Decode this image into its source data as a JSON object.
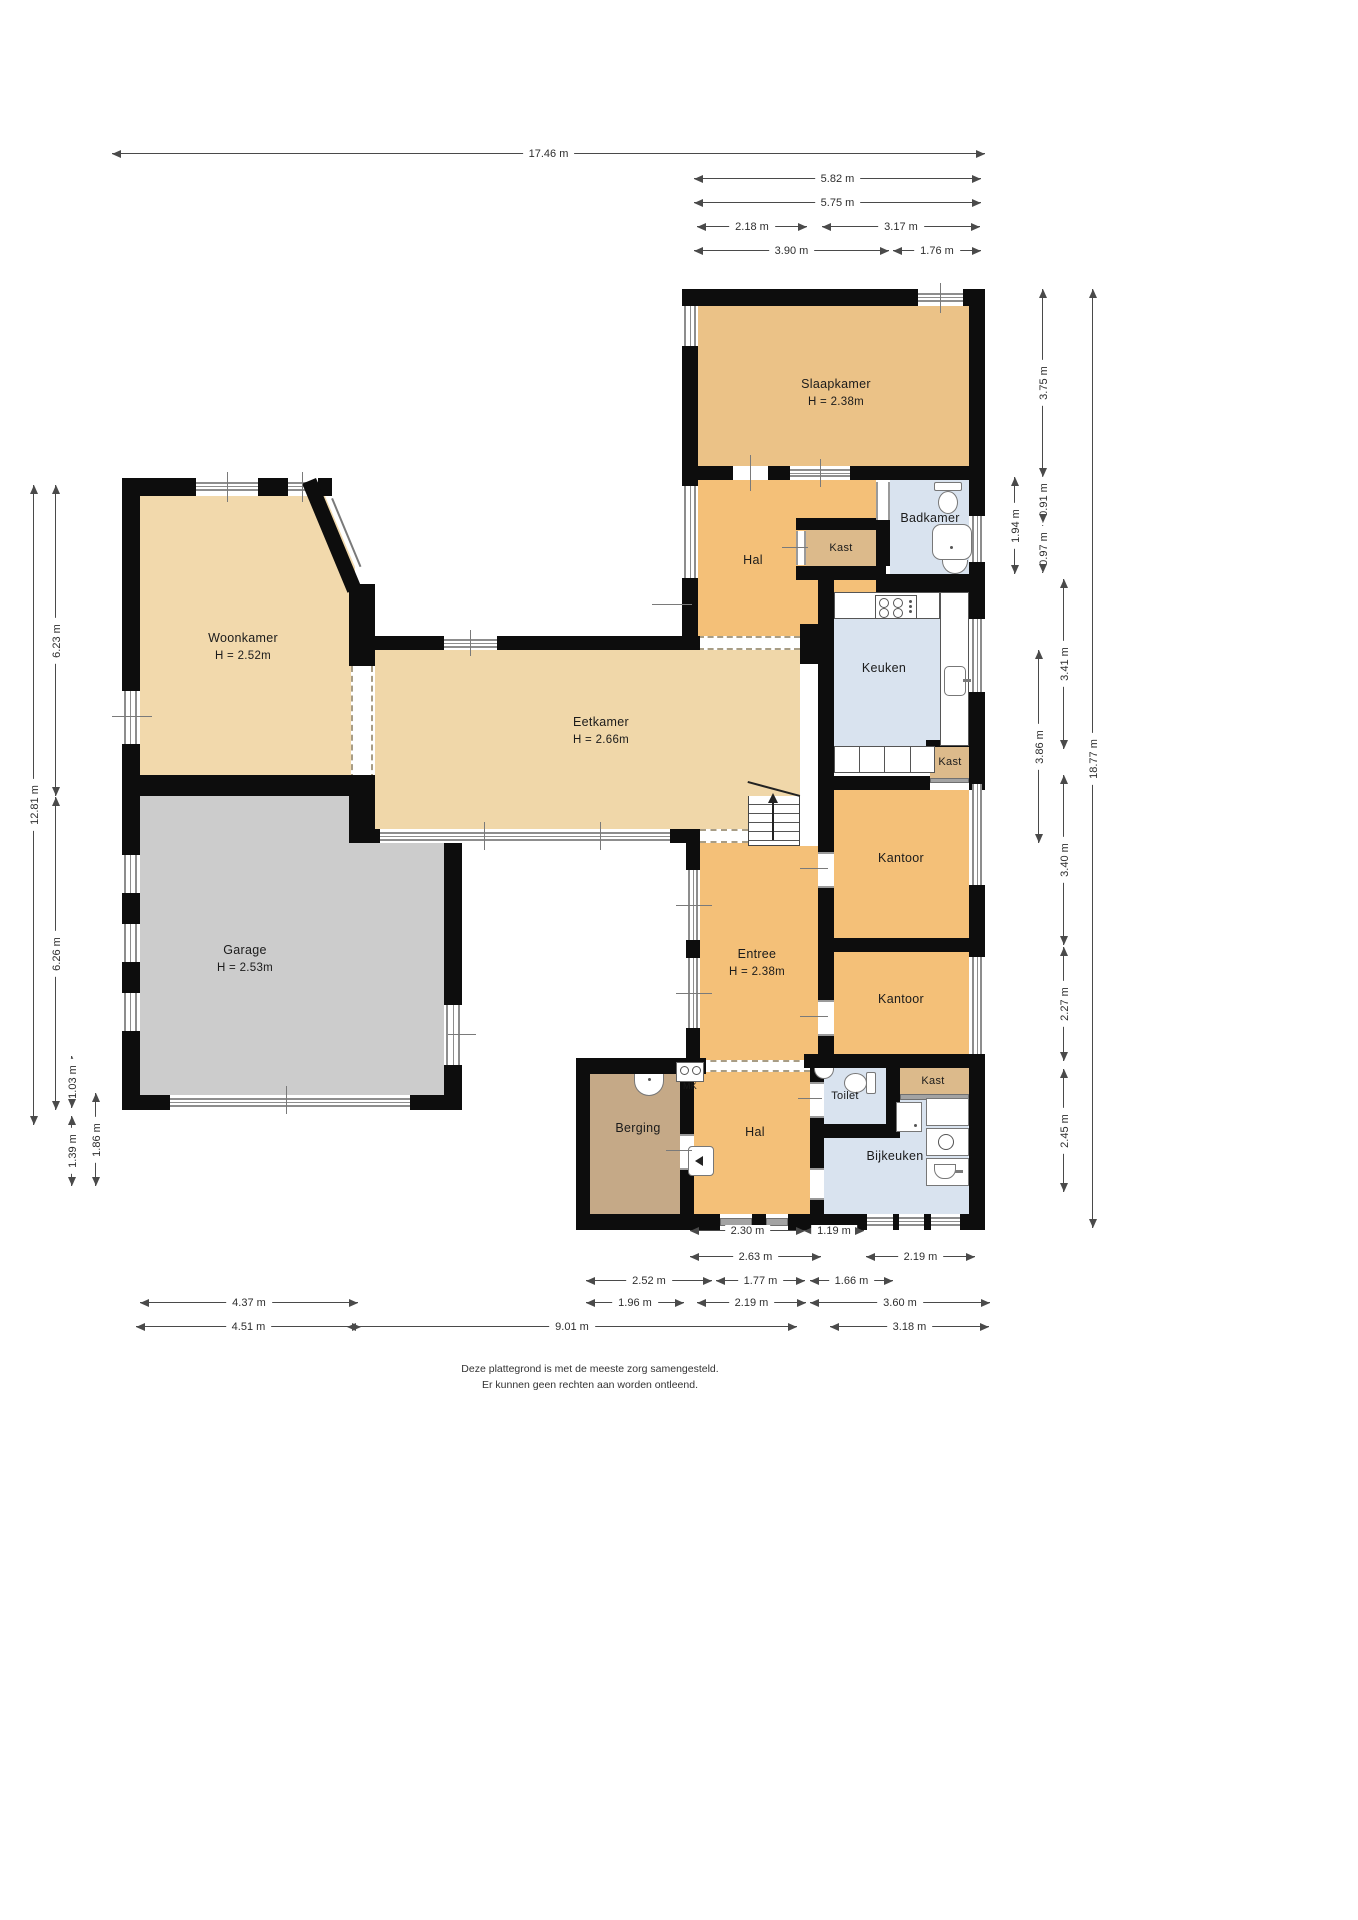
{
  "title": "Plattegrond begane grond",
  "colors": {
    "wall": "#0d0d0d",
    "room_tan_light": "#f0d7a9",
    "room_tan": "#f2d9ac",
    "room_bedroom": "#ebc287",
    "room_orange": "#f4c078",
    "room_closet": "#dcba8b",
    "room_storage": "#c5a987",
    "room_wet_blue": "#d9e3ef",
    "room_garage": "#cccccc",
    "window_gray": "#8d8d8d",
    "dimension_line": "#4a4a4a"
  },
  "rooms": {
    "slaapkamer": {
      "name": "Slaapkamer",
      "height": "H = 2.38m"
    },
    "hal_boven": {
      "name": "Hal"
    },
    "kast_boven": {
      "name": "Kast"
    },
    "badkamer": {
      "name": "Badkamer"
    },
    "keuken": {
      "name": "Keuken"
    },
    "kast_midden": {
      "name": "Kast"
    },
    "kantoor_boven": {
      "name": "Kantoor"
    },
    "kantoor_onder": {
      "name": "Kantoor"
    },
    "eetkamer": {
      "name": "Eetkamer",
      "height": "H = 2.66m"
    },
    "woonkamer": {
      "name": "Woonkamer",
      "height": "H = 2.52m"
    },
    "garage": {
      "name": "Garage",
      "height": "H = 2.53m"
    },
    "entree": {
      "name": "Entree",
      "height": "H = 2.38m"
    },
    "berging": {
      "name": "Berging"
    },
    "meterkast": {
      "name": "MK"
    },
    "hal_beneden": {
      "name": "Hal"
    },
    "toilet": {
      "name": "Toilet"
    },
    "kast_onder": {
      "name": "Kast"
    },
    "bijkeuken": {
      "name": "Bijkeuken"
    }
  },
  "dimensions": {
    "top": [
      {
        "label": "17.46 m"
      },
      {
        "label": "5.82 m"
      },
      {
        "label": "5.75 m"
      },
      {
        "label": "2.18 m"
      },
      {
        "label": "3.17 m"
      },
      {
        "label": "3.90 m"
      },
      {
        "label": "1.76 m"
      }
    ],
    "bottom": [
      {
        "label": "2.30 m"
      },
      {
        "label": "1.19 m"
      },
      {
        "label": "2.63 m"
      },
      {
        "label": "2.19 m"
      },
      {
        "label": "2.52 m"
      },
      {
        "label": "1.77 m"
      },
      {
        "label": "1.66 m"
      },
      {
        "label": "4.37 m"
      },
      {
        "label": "1.96 m"
      },
      {
        "label": "2.19 m"
      },
      {
        "label": "3.60 m"
      },
      {
        "label": "4.51 m"
      },
      {
        "label": "9.01 m"
      },
      {
        "label": "3.18 m"
      }
    ],
    "left": [
      {
        "label": "12.81 m"
      },
      {
        "label": "6.23 m"
      },
      {
        "label": "6.26 m"
      },
      {
        "label": "1.03 m"
      },
      {
        "label": "1.39 m"
      },
      {
        "label": "1.86 m"
      }
    ],
    "right": [
      {
        "label": "3.75 m"
      },
      {
        "label": "1.94 m"
      },
      {
        "label": "0.91 m"
      },
      {
        "label": "0.97 m"
      },
      {
        "label": "3.41 m"
      },
      {
        "label": "3.86 m"
      },
      {
        "label": "3.40 m"
      },
      {
        "label": "2.27 m"
      },
      {
        "label": "2.45 m"
      },
      {
        "label": "18.77 m"
      }
    ]
  },
  "icons": [
    {
      "name": "toilet-icon"
    },
    {
      "name": "shower-icon"
    },
    {
      "name": "washbasin-icon"
    },
    {
      "name": "hob-icon"
    },
    {
      "name": "kitchen-sink-icon"
    },
    {
      "name": "stairs-icon"
    },
    {
      "name": "stairs-direction-arrow-icon"
    },
    {
      "name": "hand-basin-icon"
    },
    {
      "name": "utility-sink-icon"
    },
    {
      "name": "washing-machine-icon"
    },
    {
      "name": "dryer-icon"
    },
    {
      "name": "boiler-icon"
    },
    {
      "name": "meter-cabinet-icon"
    }
  ],
  "footer": {
    "line1": "Deze plattegrond is met de meeste zorg samengesteld.",
    "line2": "Er kunnen geen rechten aan worden ontleend."
  }
}
